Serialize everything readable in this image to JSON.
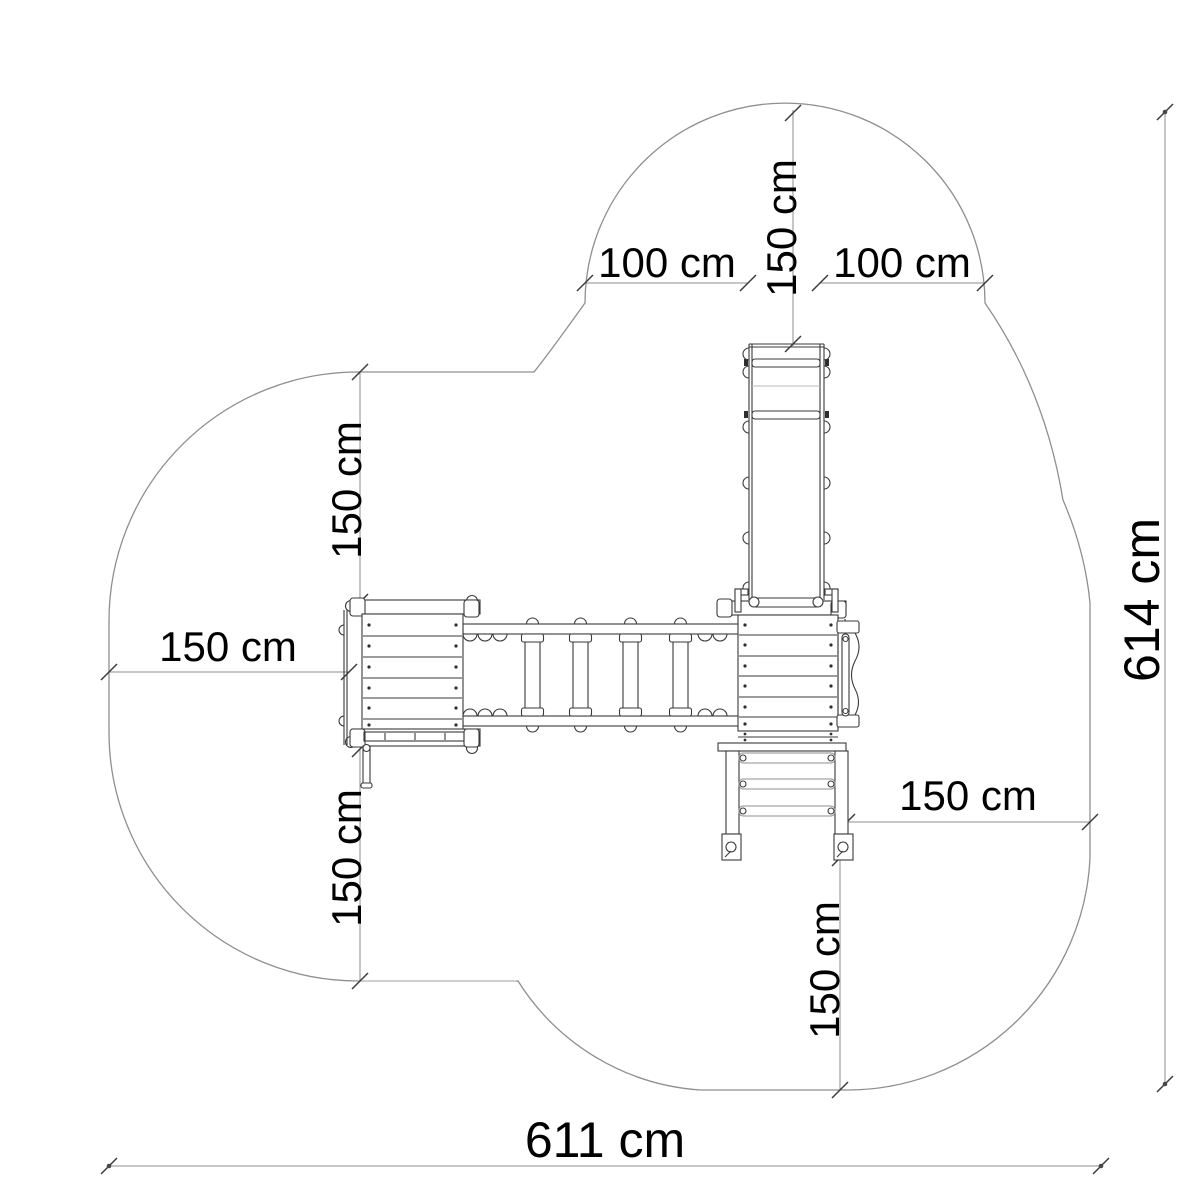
{
  "drawing_type": "playground-equipment-plan-view-with-safety-zone",
  "dims": {
    "top_left": {
      "label": "100 cm",
      "orientation": "horizontal"
    },
    "top_center": {
      "label": "150 cm",
      "orientation": "vertical"
    },
    "top_right": {
      "label": "100 cm",
      "orientation": "horizontal"
    },
    "left_upper": {
      "label": "150 cm",
      "orientation": "vertical"
    },
    "left_middle": {
      "label": "150 cm",
      "orientation": "horizontal"
    },
    "left_lower": {
      "label": "150 cm",
      "orientation": "vertical"
    },
    "right_middle": {
      "label": "150 cm",
      "orientation": "horizontal"
    },
    "bottom_right": {
      "label": "150 cm",
      "orientation": "vertical"
    },
    "overall_width": {
      "label": "611 cm",
      "orientation": "horizontal"
    },
    "overall_height": {
      "label": "614 cm",
      "orientation": "vertical"
    }
  },
  "colors": {
    "background": "#ffffff",
    "safety_zone_outline": "#8d9091",
    "structure_line": "#3a3a3a",
    "dimension_line": "#8c8c8c",
    "light_line": "#b9bcbd",
    "text": "#000000"
  }
}
